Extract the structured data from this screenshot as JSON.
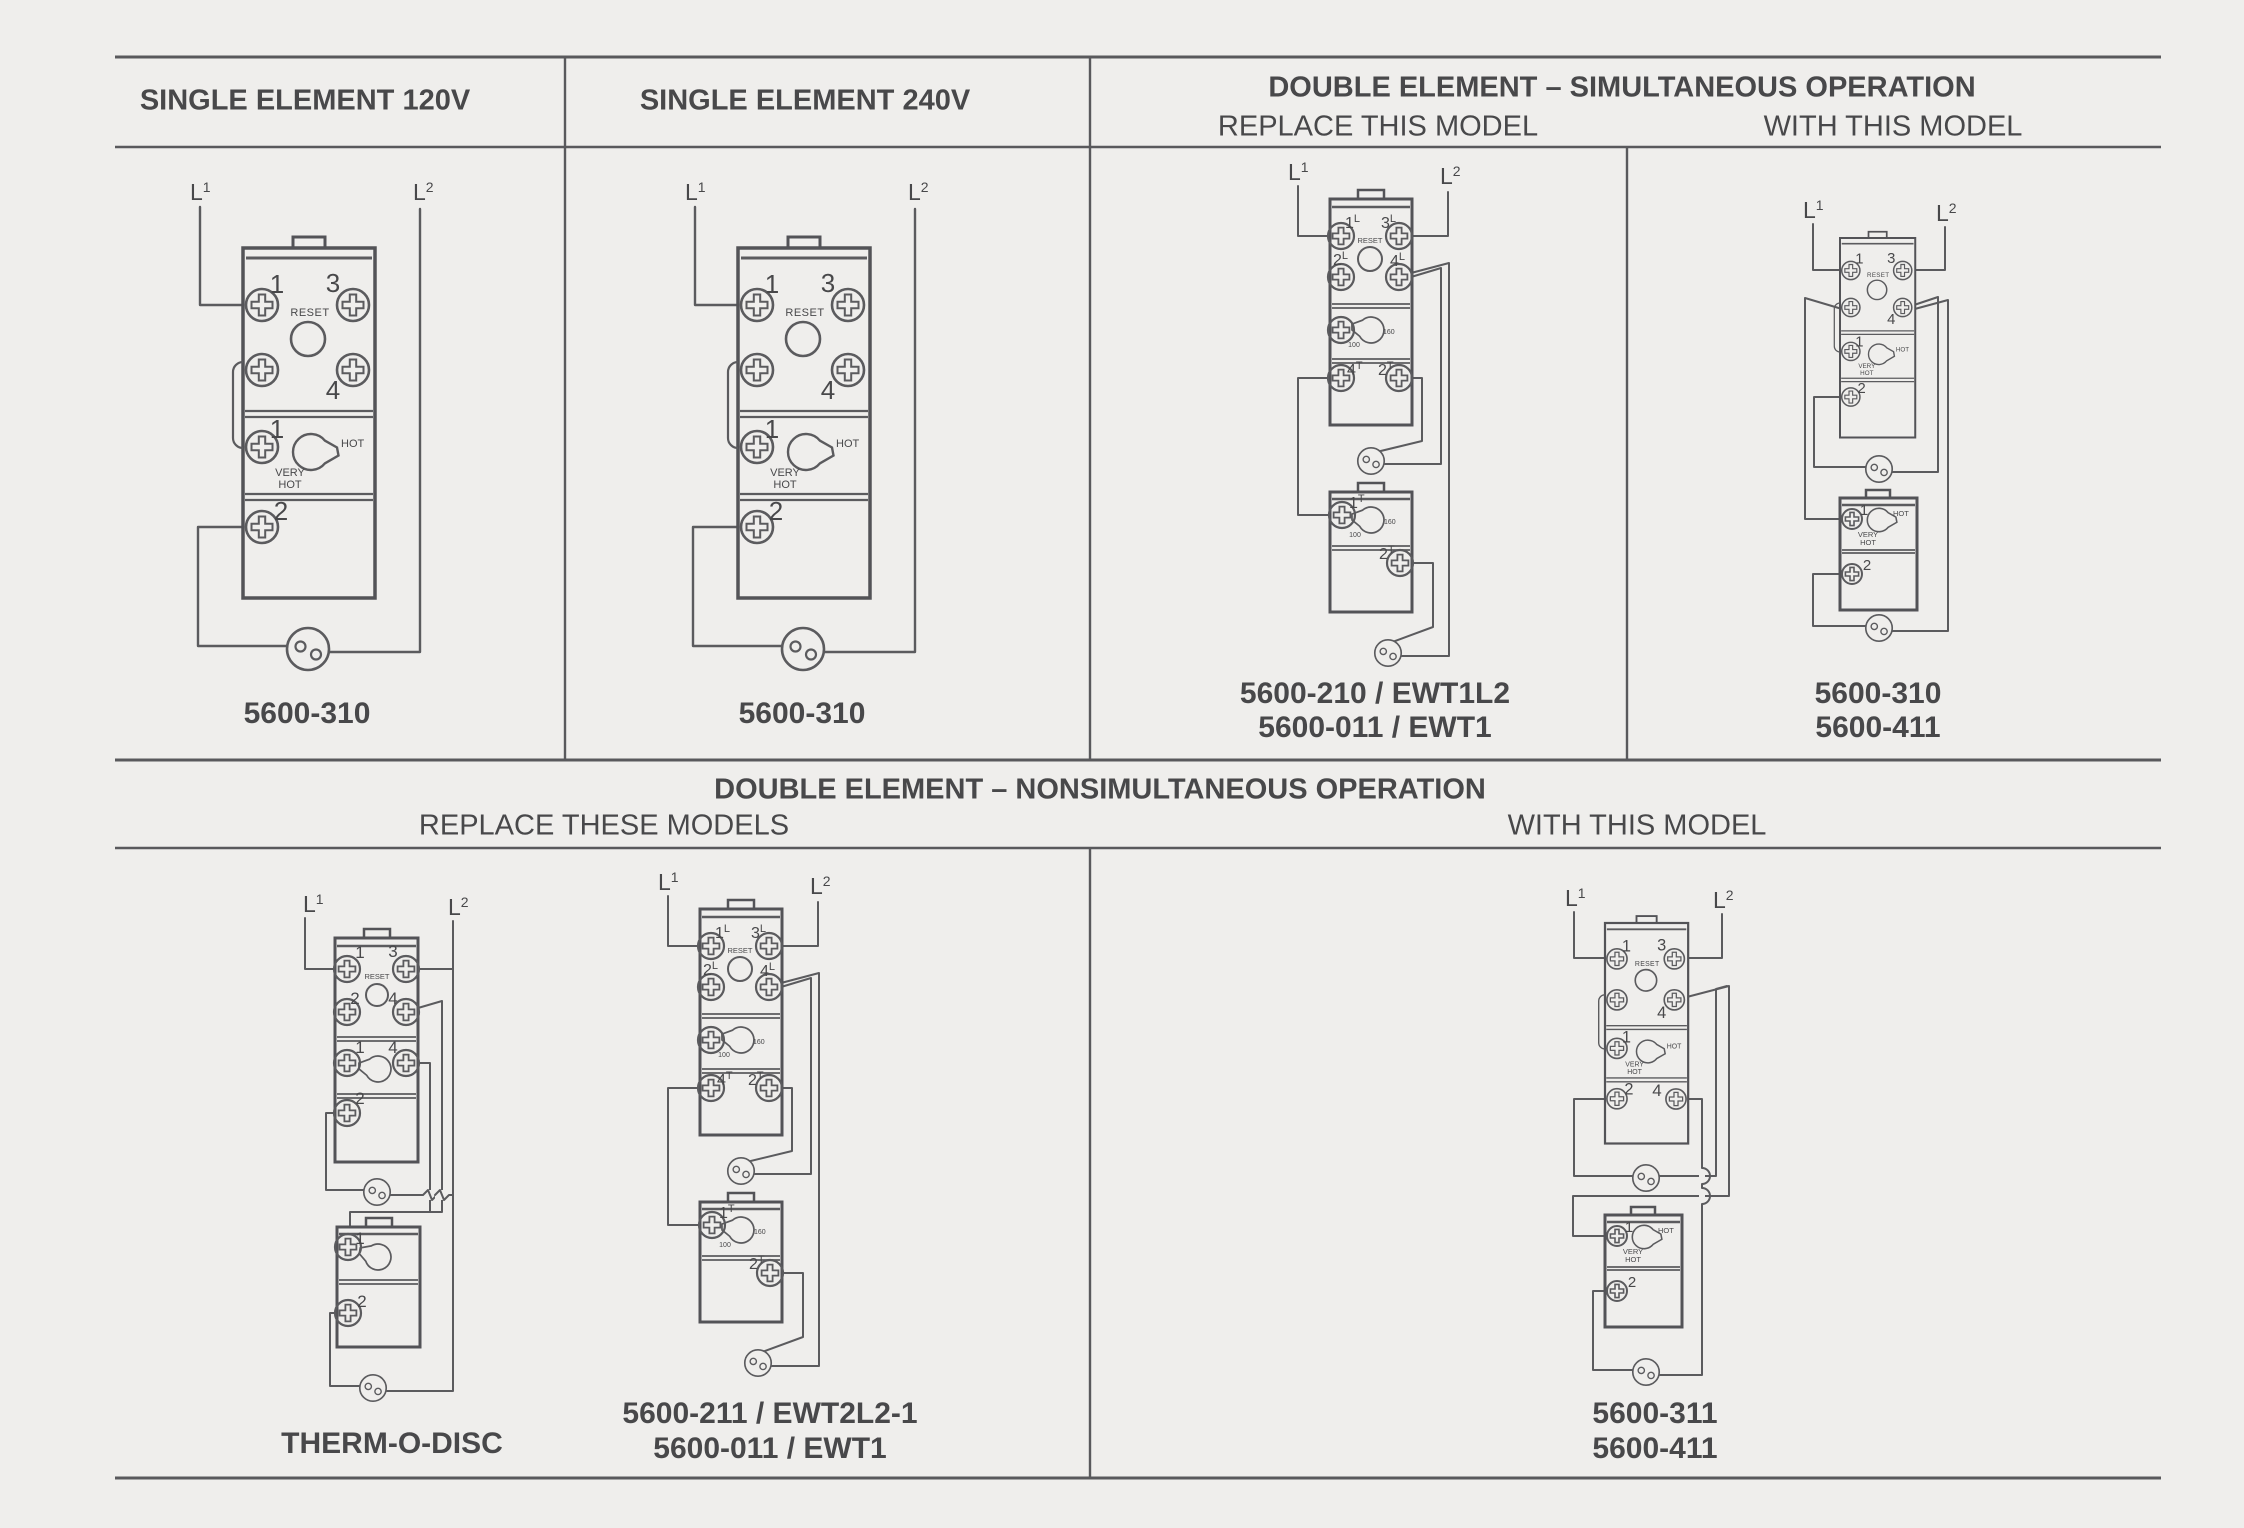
{
  "page": {
    "background": "#efeeec",
    "line_color": "#59595c",
    "text_color": "#48484a"
  },
  "headers": {
    "col1": "SINGLE ELEMENT 120V",
    "col2": "SINGLE ELEMENT 240V",
    "col3": "DOUBLE ELEMENT – SIMULTANEOUS OPERATION",
    "col3_left": "REPLACE THIS MODEL",
    "col3_right": "WITH THIS MODEL",
    "bottom": "DOUBLE ELEMENT – NONSIMULTANEOUS OPERATION",
    "bottom_left": "REPLACE THESE MODELS",
    "bottom_right": "WITH THIS MODEL"
  },
  "models": {
    "single_120": "5600-310",
    "single_240": "5600-310",
    "sim_replace_1": "5600-210 / EWT1L2",
    "sim_replace_2": "5600-011 / EWT1",
    "sim_with_1": "5600-310",
    "sim_with_2": "5600-411",
    "nonsim_replace_a": "THERM-O-DISC",
    "nonsim_replace_b1": "5600-211 / EWT2L2-1",
    "nonsim_replace_b2": "5600-011 / EWT1",
    "nonsim_with_1": "5600-311",
    "nonsim_with_2": "5600-411"
  },
  "labels": {
    "line1": "L",
    "line1_sup": "1",
    "line2": "L",
    "line2_sup": "2",
    "reset": "RESET",
    "hot": "HOT",
    "very": "VERY",
    "very_hot2": "HOT",
    "dial_low": "100",
    "dial_high": "160",
    "t1": "1",
    "t2": "2",
    "t3": "3",
    "t4": "4",
    "sup_l": "L",
    "sup_t": "T"
  }
}
